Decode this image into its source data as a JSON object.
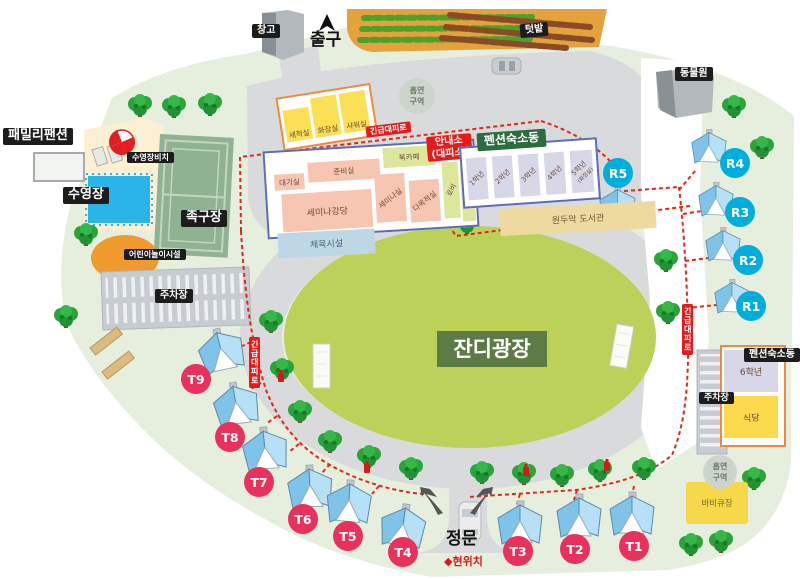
{
  "colors": {
    "park_green": "#e6efde",
    "road_gray": "#d9dadb",
    "plaza_green": "#bcd159",
    "plaza_label_bg": "#5d7b45",
    "tent_t_circle": "#e8315d",
    "tent_r_circle": "#00aede",
    "route_red": "#e22814",
    "alert_red": "#e61a1a",
    "label_black": "#1c1c1c",
    "pension_label_green": "#2d6b40"
  },
  "top": {
    "warehouse": "창고",
    "exit": "출구",
    "garden": "텃밭",
    "zoo": "동물원"
  },
  "west": {
    "family_pension": "패밀리팬션",
    "pool_beach": "수영장비치",
    "pool": "수영장",
    "jokgu_court": "족구장",
    "children_play": "어린이놀이시설",
    "parking": "주차장"
  },
  "service_building": {
    "washroom": "세척실",
    "toilet": "화장실",
    "shower": "샤워실"
  },
  "main_building": {
    "waiting_room": "대기실",
    "prep_room": "준비실",
    "book_cafe": "북카페",
    "seminar_hall": "세미나강당",
    "seminar_room": "세미나실",
    "multipurpose_room": "다목적실",
    "lobby": "로비",
    "store": "매점",
    "info_line1": "안내소",
    "info_line2": "(대피소)"
  },
  "pension": {
    "label": "펜션숙소동",
    "grade1": "1학년",
    "grade2": "2학년",
    "grade3": "3학년",
    "grade4": "4학년",
    "grade5": "5학년",
    "grade5_note": "(화장실)",
    "library": "원두막 도서관",
    "sports_facility": "체육시설"
  },
  "plaza": {
    "label": "잔디광장"
  },
  "east": {
    "pension_label": "펜션숙소동",
    "grade6": "6학년",
    "restaurant": "식당",
    "parking": "주차장",
    "bbq": "바비큐장"
  },
  "smoking": {
    "line1": "흡연",
    "line2": "구역"
  },
  "gate": {
    "main_gate": "정문",
    "marker": "◆",
    "current_location": "현위치"
  },
  "route": {
    "emergency": "긴급대피로"
  },
  "tents": {
    "t": [
      "T1",
      "T2",
      "T3",
      "T4",
      "T5",
      "T6",
      "T7",
      "T8",
      "T9"
    ],
    "r": [
      "R1",
      "R2",
      "R3",
      "R4",
      "R5"
    ]
  }
}
